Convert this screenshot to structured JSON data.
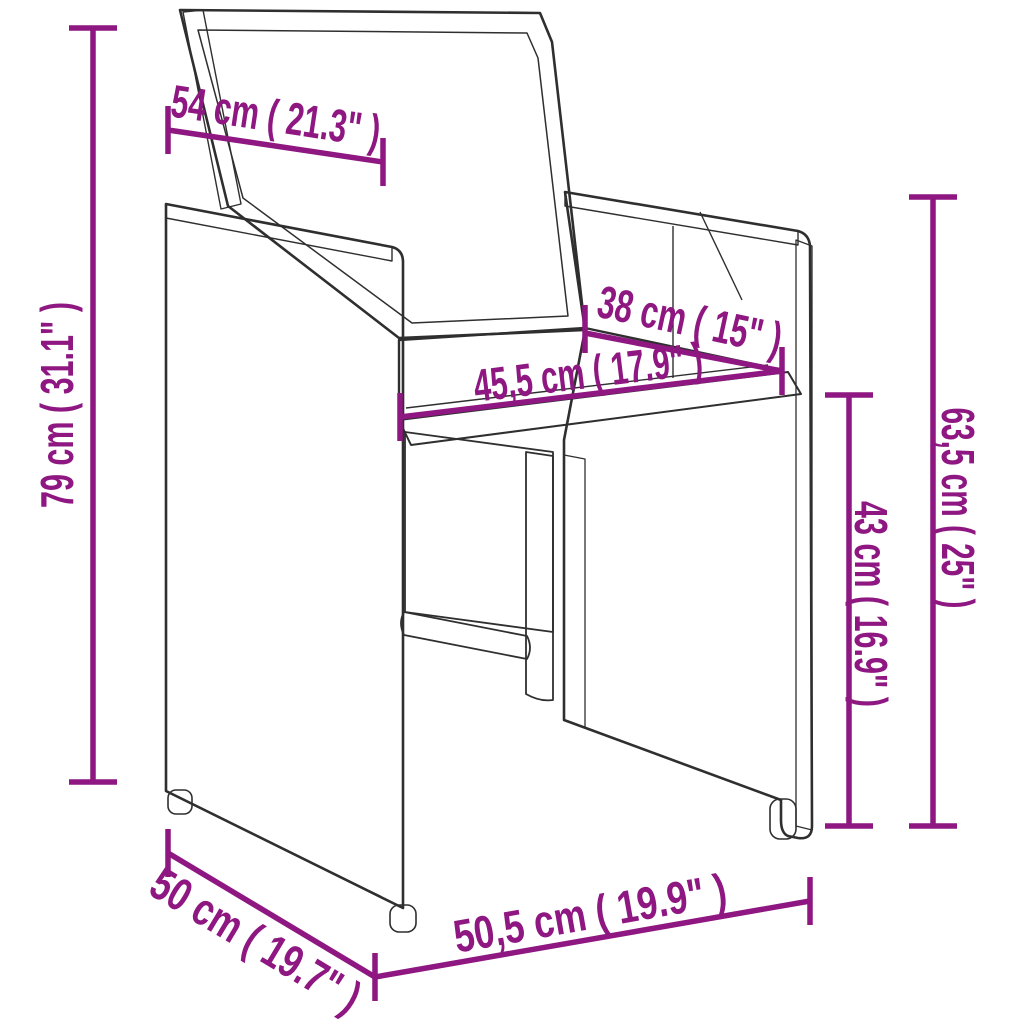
{
  "page": {
    "background": "#ffffff",
    "title": "Wicker cube armchair dimension diagram"
  },
  "diagram": {
    "subject": "poly-rattan cube armchair with seat and back cushions",
    "style": "technical line drawing with dimension callouts",
    "accent_color": "#8E1781",
    "line_color": "#2f2f2f",
    "dimensions": {
      "backrest_width": {
        "label": "54 cm ( 21.3\" )",
        "cm": "54",
        "inches": "21.3"
      },
      "total_height": {
        "label": "79 cm ( 31.1\" )",
        "cm": "79",
        "inches": "31.1"
      },
      "seat_depth": {
        "label": "38 cm ( 15\" )",
        "cm": "38",
        "inches": "15"
      },
      "seat_width": {
        "label": "45,5 cm ( 17.9\" )",
        "cm": "45,5",
        "inches": "17.9"
      },
      "armrest_height": {
        "label": "63,5 cm ( 25\" )",
        "cm": "63,5",
        "inches": "25"
      },
      "seat_height": {
        "label": "43 cm ( 16.9\" )",
        "cm": "43",
        "inches": "16.9"
      },
      "base_depth": {
        "label": "50 cm ( 19.7\" )",
        "cm": "50",
        "inches": "19.7"
      },
      "base_width": {
        "label": "50,5 cm ( 19.9\" )",
        "cm": "50,5",
        "inches": "19.9"
      }
    }
  }
}
